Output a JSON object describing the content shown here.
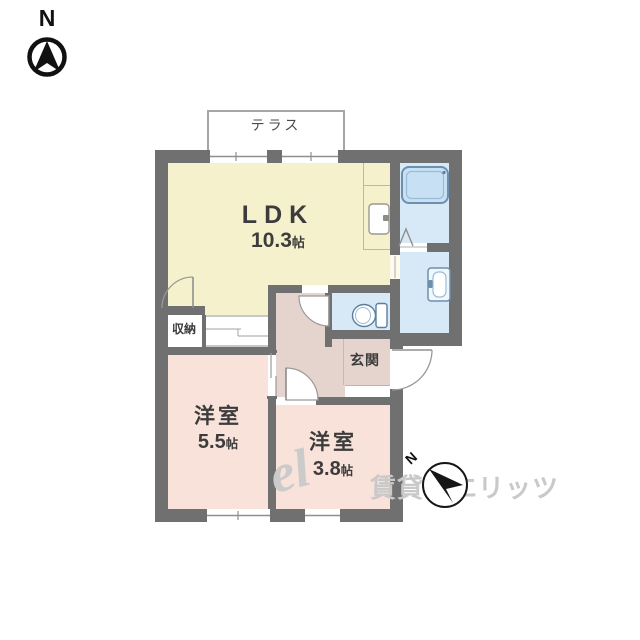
{
  "compass": {
    "north_label": "N",
    "secondary_north_label": "N"
  },
  "terrace": {
    "label": "テラス"
  },
  "rooms": {
    "ldk": {
      "name": "LDK",
      "size_value": "10.3",
      "size_unit": "帖"
    },
    "bedroom_left": {
      "name": "洋室",
      "size_value": "5.5",
      "size_unit": "帖"
    },
    "bedroom_right": {
      "name": "洋室",
      "size_value": "3.8",
      "size_unit": "帖"
    },
    "storage": {
      "name": "収納"
    },
    "entrance": {
      "name": "玄関"
    }
  },
  "fixtures": {
    "bathtub": "bathtub",
    "kitchen_sink": "kitchen-sink",
    "washbasin": "washbasin",
    "toilet": "toilet"
  },
  "watermark": {
    "logo_script": "el",
    "text": "賃貸のエリッツ"
  },
  "colors": {
    "wall": "#707070",
    "ldk_floor": "#f6f1cd",
    "bedroom_floor": "#f8e2d9",
    "hall_floor": "#e5d3cd",
    "wet_area_floor": "#d7e9f7",
    "bathtub_fill": "#c7e0f3",
    "fixture_outline": "#6d8fae",
    "watermark_gray": "#c9c9c9"
  }
}
